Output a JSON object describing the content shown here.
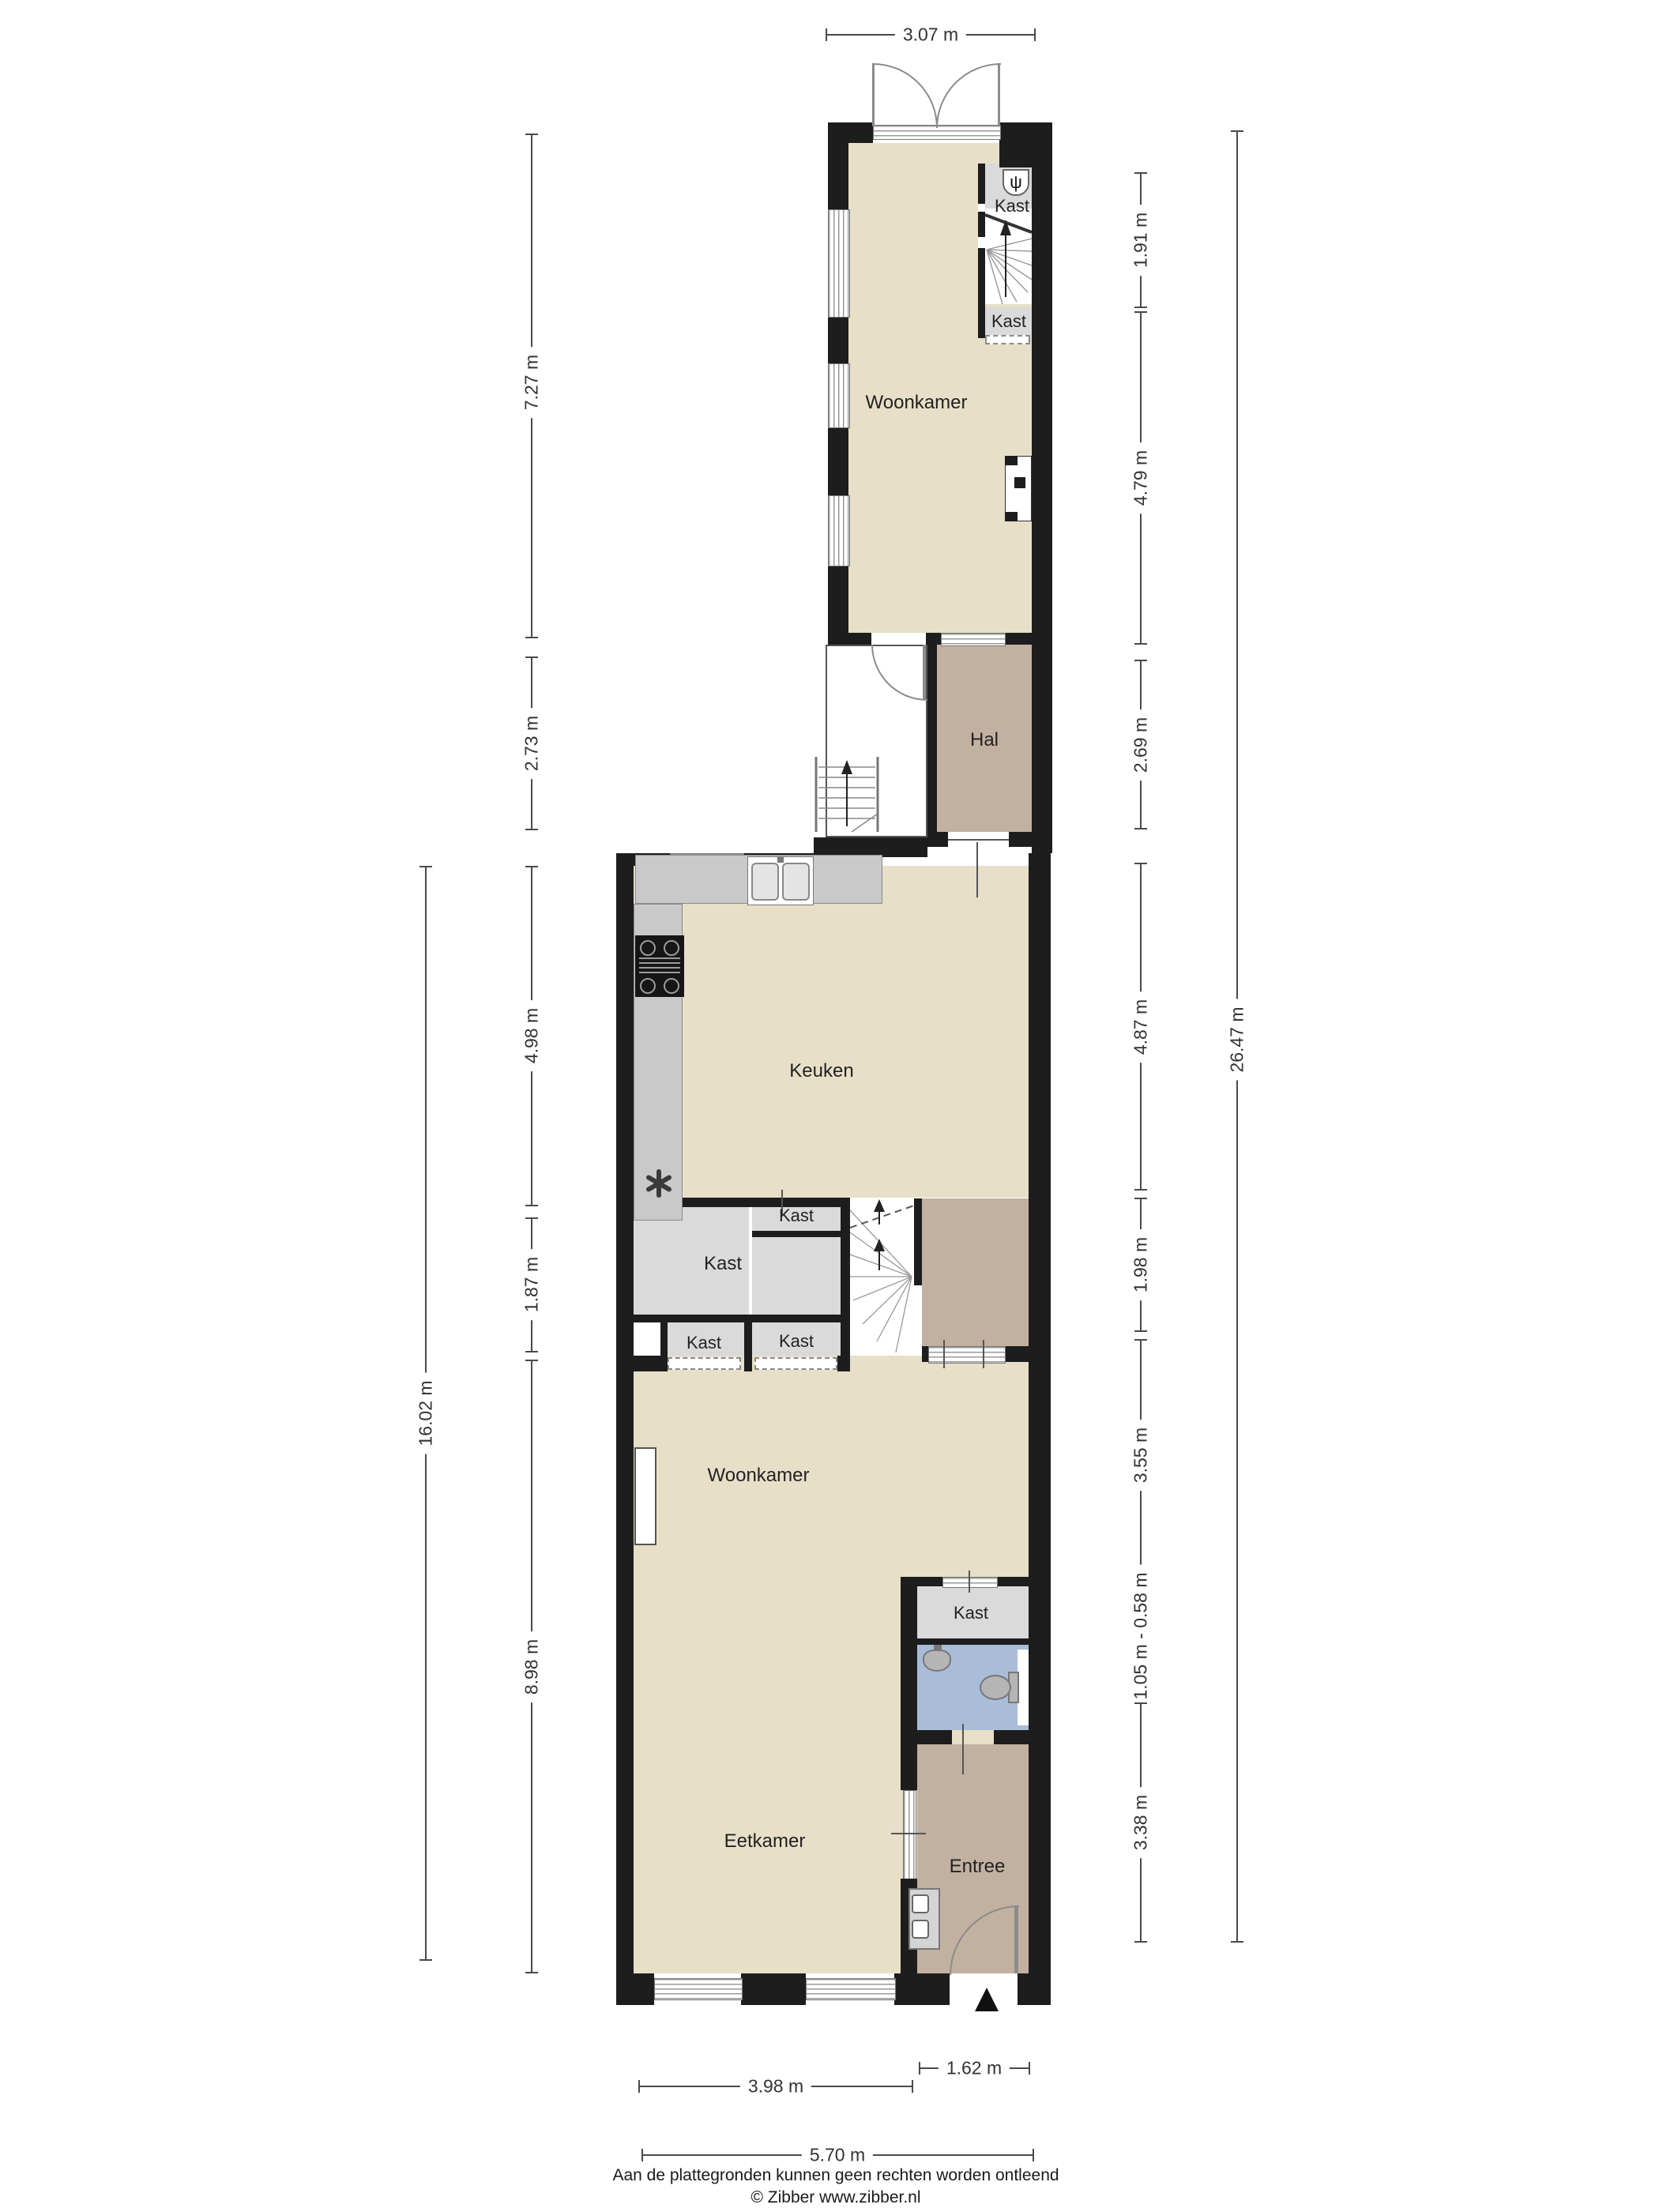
{
  "labels": {
    "woonkamer": "Woonkamer",
    "hal": "Hal",
    "keuken": "Keuken",
    "kast": "Kast",
    "eetkamer": "Eetkamer",
    "entree": "Entree"
  },
  "dimensions": {
    "top": "3.07 m",
    "left": [
      "7.27 m",
      "2.73 m",
      "4.98 m",
      "1.87 m",
      "8.98 m"
    ],
    "far_left": "16.02 m",
    "right": [
      "1.91 m",
      "4.79 m",
      "2.69 m",
      "4.87 m",
      "1.98 m",
      "3.55 m",
      "1.05 m - 0.58 m",
      "3.38 m"
    ],
    "far_right": "26.47 m",
    "bottom": [
      "3.98 m",
      "1.62 m",
      "5.70 m"
    ]
  },
  "footer": {
    "line1": "Aan de plattegronden kunnen geen rechten worden ontleend",
    "line2": "© Zibber www.zibber.nl"
  },
  "colors": {
    "floor_beige": "#e7dfc8",
    "floor_brown": "#c2b1a1",
    "closet_gray": "#dadada",
    "counter_gray": "#c9c9c9",
    "bath_blue": "#a9bdd9",
    "wall": "#1d1d1d"
  },
  "icons": {
    "boiler": "ψ"
  }
}
